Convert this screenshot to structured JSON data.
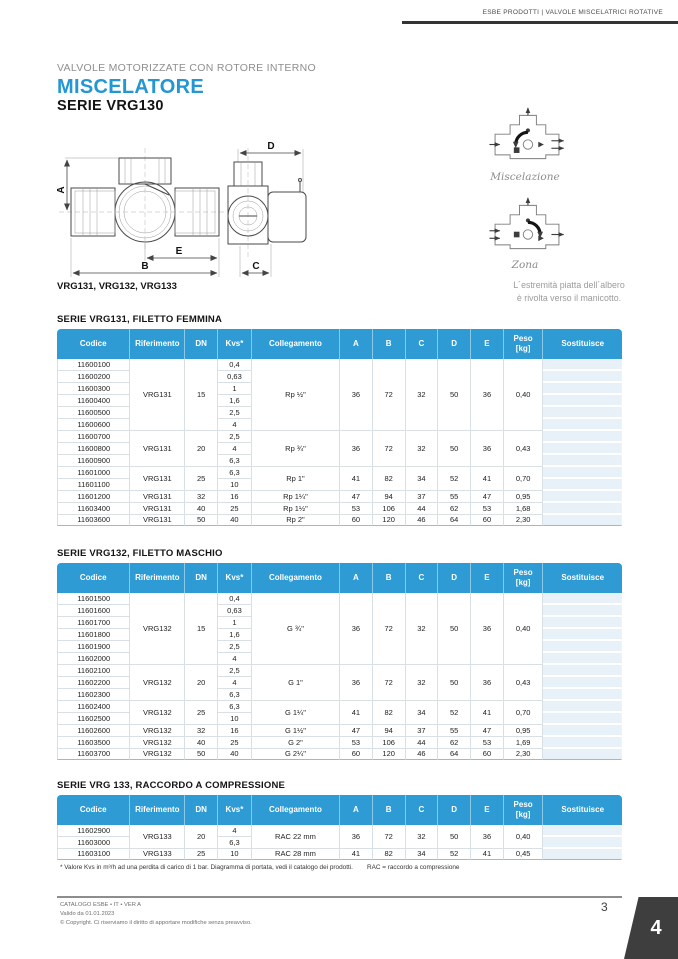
{
  "header": {
    "breadcrumb": "ESBE PRODOTTI | VALVOLE MISCELATRICI ROTATIVE"
  },
  "intro": {
    "eyebrow": "VALVOLE MOTORIZZATE CON ROTORE INTERNO",
    "title": "MISCELATORE",
    "series": "SERIE VRG130"
  },
  "diagram": {
    "caption": "VRG131, VRG132, VRG133",
    "dim_labels": {
      "a": "A",
      "b": "B",
      "c": "C",
      "d": "D",
      "e": "E"
    }
  },
  "side_panel": {
    "mix_label": "Miscelazione",
    "zone_label": "Zona",
    "note_line1": "L´estremità piatta dell´albero",
    "note_line2": "è rivolta verso il manicotto."
  },
  "colors": {
    "accent": "#2496d4",
    "table_header": "#2e9bd4",
    "corner_tab": "#3e3e3e"
  },
  "tables": [
    {
      "title": "SERIE VRG131, FILETTO FEMMINA",
      "columns": [
        "Codice",
        "Riferimento",
        "DN",
        "Kvs*",
        "Collegamento",
        "A",
        "B",
        "C",
        "D",
        "E",
        "Peso\n[kg]",
        "Sostituisce"
      ],
      "groups": [
        {
          "riferimento": "VRG131",
          "dn": "15",
          "collegamento": "Rp ½\"",
          "a": "36",
          "b": "72",
          "c": "32",
          "d": "50",
          "e": "36",
          "peso": "0,40",
          "rows": [
            {
              "codice": "11600100",
              "kvs": "0,4"
            },
            {
              "codice": "11600200",
              "kvs": "0,63"
            },
            {
              "codice": "11600300",
              "kvs": "1"
            },
            {
              "codice": "11600400",
              "kvs": "1,6"
            },
            {
              "codice": "11600500",
              "kvs": "2,5"
            },
            {
              "codice": "11600600",
              "kvs": "4"
            }
          ]
        },
        {
          "riferimento": "VRG131",
          "dn": "20",
          "collegamento": "Rp ¾\"",
          "a": "36",
          "b": "72",
          "c": "32",
          "d": "50",
          "e": "36",
          "peso": "0,43",
          "rows": [
            {
              "codice": "11600700",
              "kvs": "2,5"
            },
            {
              "codice": "11600800",
              "kvs": "4"
            },
            {
              "codice": "11600900",
              "kvs": "6,3"
            }
          ]
        },
        {
          "riferimento": "VRG131",
          "dn": "25",
          "collegamento": "Rp 1\"",
          "a": "41",
          "b": "82",
          "c": "34",
          "d": "52",
          "e": "41",
          "peso": "0,70",
          "rows": [
            {
              "codice": "11601000",
              "kvs": "6,3"
            },
            {
              "codice": "11601100",
              "kvs": "10"
            }
          ]
        },
        {
          "riferimento": "VRG131",
          "dn": "32",
          "collegamento": "Rp 1¼\"",
          "a": "47",
          "b": "94",
          "c": "37",
          "d": "55",
          "e": "47",
          "peso": "0,95",
          "rows": [
            {
              "codice": "11601200",
              "kvs": "16"
            }
          ]
        },
        {
          "riferimento": "VRG131",
          "dn": "40",
          "collegamento": "Rp 1½\"",
          "a": "53",
          "b": "106",
          "c": "44",
          "d": "62",
          "e": "53",
          "peso": "1,68",
          "rows": [
            {
              "codice": "11603400",
              "kvs": "25"
            }
          ]
        },
        {
          "riferimento": "VRG131",
          "dn": "50",
          "collegamento": "Rp 2\"",
          "a": "60",
          "b": "120",
          "c": "46",
          "d": "64",
          "e": "60",
          "peso": "2,30",
          "rows": [
            {
              "codice": "11603600",
              "kvs": "40"
            }
          ]
        }
      ]
    },
    {
      "title": "SERIE VRG132, FILETTO MASCHIO",
      "columns": [
        "Codice",
        "Riferimento",
        "DN",
        "Kvs*",
        "Collegamento",
        "A",
        "B",
        "C",
        "D",
        "E",
        "Peso\n[kg]",
        "Sostituisce"
      ],
      "groups": [
        {
          "riferimento": "VRG132",
          "dn": "15",
          "collegamento": "G ¾\"",
          "a": "36",
          "b": "72",
          "c": "32",
          "d": "50",
          "e": "36",
          "peso": "0,40",
          "rows": [
            {
              "codice": "11601500",
              "kvs": "0,4"
            },
            {
              "codice": "11601600",
              "kvs": "0,63"
            },
            {
              "codice": "11601700",
              "kvs": "1"
            },
            {
              "codice": "11601800",
              "kvs": "1,6"
            },
            {
              "codice": "11601900",
              "kvs": "2,5"
            },
            {
              "codice": "11602000",
              "kvs": "4"
            }
          ]
        },
        {
          "riferimento": "VRG132",
          "dn": "20",
          "collegamento": "G 1\"",
          "a": "36",
          "b": "72",
          "c": "32",
          "d": "50",
          "e": "36",
          "peso": "0,43",
          "rows": [
            {
              "codice": "11602100",
              "kvs": "2,5"
            },
            {
              "codice": "11602200",
              "kvs": "4"
            },
            {
              "codice": "11602300",
              "kvs": "6,3"
            }
          ]
        },
        {
          "riferimento": "VRG132",
          "dn": "25",
          "collegamento": "G 1¼\"",
          "a": "41",
          "b": "82",
          "c": "34",
          "d": "52",
          "e": "41",
          "peso": "0,70",
          "rows": [
            {
              "codice": "11602400",
              "kvs": "6,3"
            },
            {
              "codice": "11602500",
              "kvs": "10"
            }
          ]
        },
        {
          "riferimento": "VRG132",
          "dn": "32",
          "collegamento": "G 1½\"",
          "a": "47",
          "b": "94",
          "c": "37",
          "d": "55",
          "e": "47",
          "peso": "0,95",
          "rows": [
            {
              "codice": "11602600",
              "kvs": "16"
            }
          ]
        },
        {
          "riferimento": "VRG132",
          "dn": "40",
          "collegamento": "G 2\"",
          "a": "53",
          "b": "106",
          "c": "44",
          "d": "62",
          "e": "53",
          "peso": "1,69",
          "rows": [
            {
              "codice": "11603500",
              "kvs": "25"
            }
          ]
        },
        {
          "riferimento": "VRG132",
          "dn": "50",
          "collegamento": "G 2¼\"",
          "a": "60",
          "b": "120",
          "c": "46",
          "d": "64",
          "e": "60",
          "peso": "2,30",
          "rows": [
            {
              "codice": "11603700",
              "kvs": "40"
            }
          ]
        }
      ]
    },
    {
      "title": "SERIE VRG 133, RACCORDO A COMPRESSIONE",
      "columns": [
        "Codice",
        "Riferimento",
        "DN",
        "Kvs*",
        "Collegamento",
        "A",
        "B",
        "C",
        "D",
        "E",
        "Peso\n[kg]",
        "Sostituisce"
      ],
      "groups": [
        {
          "riferimento": "VRG133",
          "dn": "20",
          "collegamento": "RAC 22 mm",
          "a": "36",
          "b": "72",
          "c": "32",
          "d": "50",
          "e": "36",
          "peso": "0,40",
          "rows": [
            {
              "codice": "11602900",
              "kvs": "4"
            },
            {
              "codice": "11603000",
              "kvs": "6,3"
            }
          ]
        },
        {
          "riferimento": "VRG133",
          "dn": "25",
          "collegamento": "RAC 28 mm",
          "a": "41",
          "b": "82",
          "c": "34",
          "d": "52",
          "e": "41",
          "peso": "0,45",
          "rows": [
            {
              "codice": "11603100",
              "kvs": "10"
            }
          ]
        }
      ]
    }
  ],
  "footnote": {
    "kvs": "* Valore Kvs in m³/h ad una perdita di carico di 1 bar. Diagramma di portata, vedi il catalogo dei prodotti.",
    "rac": "RAC = raccordo a compressione"
  },
  "footer": {
    "line1": "CATALOGO ESBE • IT • VER A",
    "line2": "Valido da 01.01.2023",
    "line3": "© Copyright. Ci riserviamo il diritto di apportare modifiche senza preavviso.",
    "page_number": "3",
    "corner_tab": "4"
  }
}
